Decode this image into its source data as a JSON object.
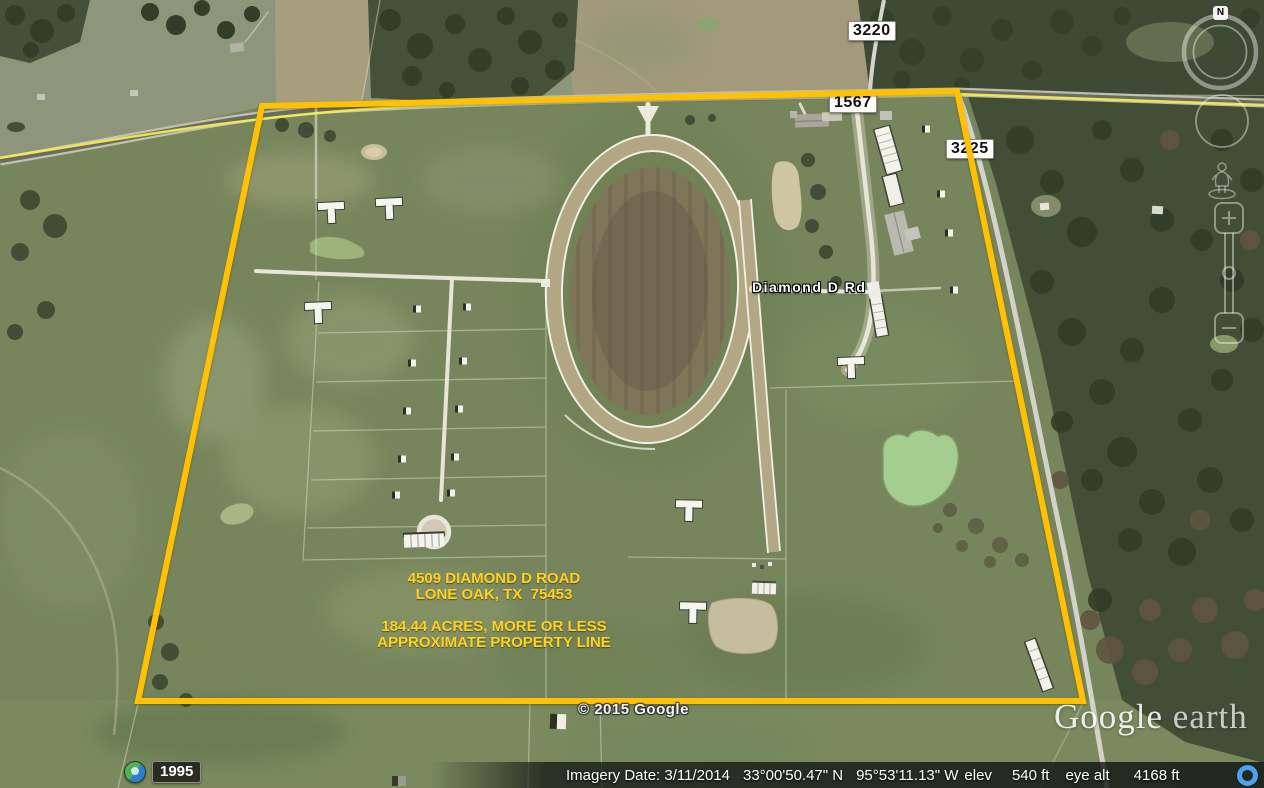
{
  "window": {
    "width": 1264,
    "height": 788,
    "app": "Google Earth"
  },
  "road_shields": {
    "route_a": "3220",
    "route_b": "1567",
    "route_c": "3225"
  },
  "street_label": "Diamond D Rd",
  "annotation": {
    "address_line1": "4509 DIAMOND D ROAD",
    "address_line2": "LONE OAK, TX  75453",
    "acreage_line1": "184.44 ACRES, MORE OR LESS",
    "acreage_line2": "APPROXIMATE PROPERTY LINE"
  },
  "overlay": {
    "copyright": "© 2015 Google",
    "watermark_google": "Google",
    "watermark_earth": " earth"
  },
  "time_slider": {
    "year": "1995"
  },
  "compass": {
    "north": "N"
  },
  "status_bar": {
    "imagery_date": "Imagery Date: 3/11/2014",
    "latitude": "33°00'50.47\" N",
    "longitude": "95°53'11.13\" W",
    "elev_label": "elev",
    "elevation": "540 ft",
    "eye_alt_label": "eye alt",
    "eye_altitude": "4168 ft"
  },
  "colors": {
    "property_line": "#ffc103",
    "road_overlay_yellow": "#f6ee4d",
    "annotation_text": "#ffd21f",
    "stream_indicator": "#49a4f0"
  }
}
